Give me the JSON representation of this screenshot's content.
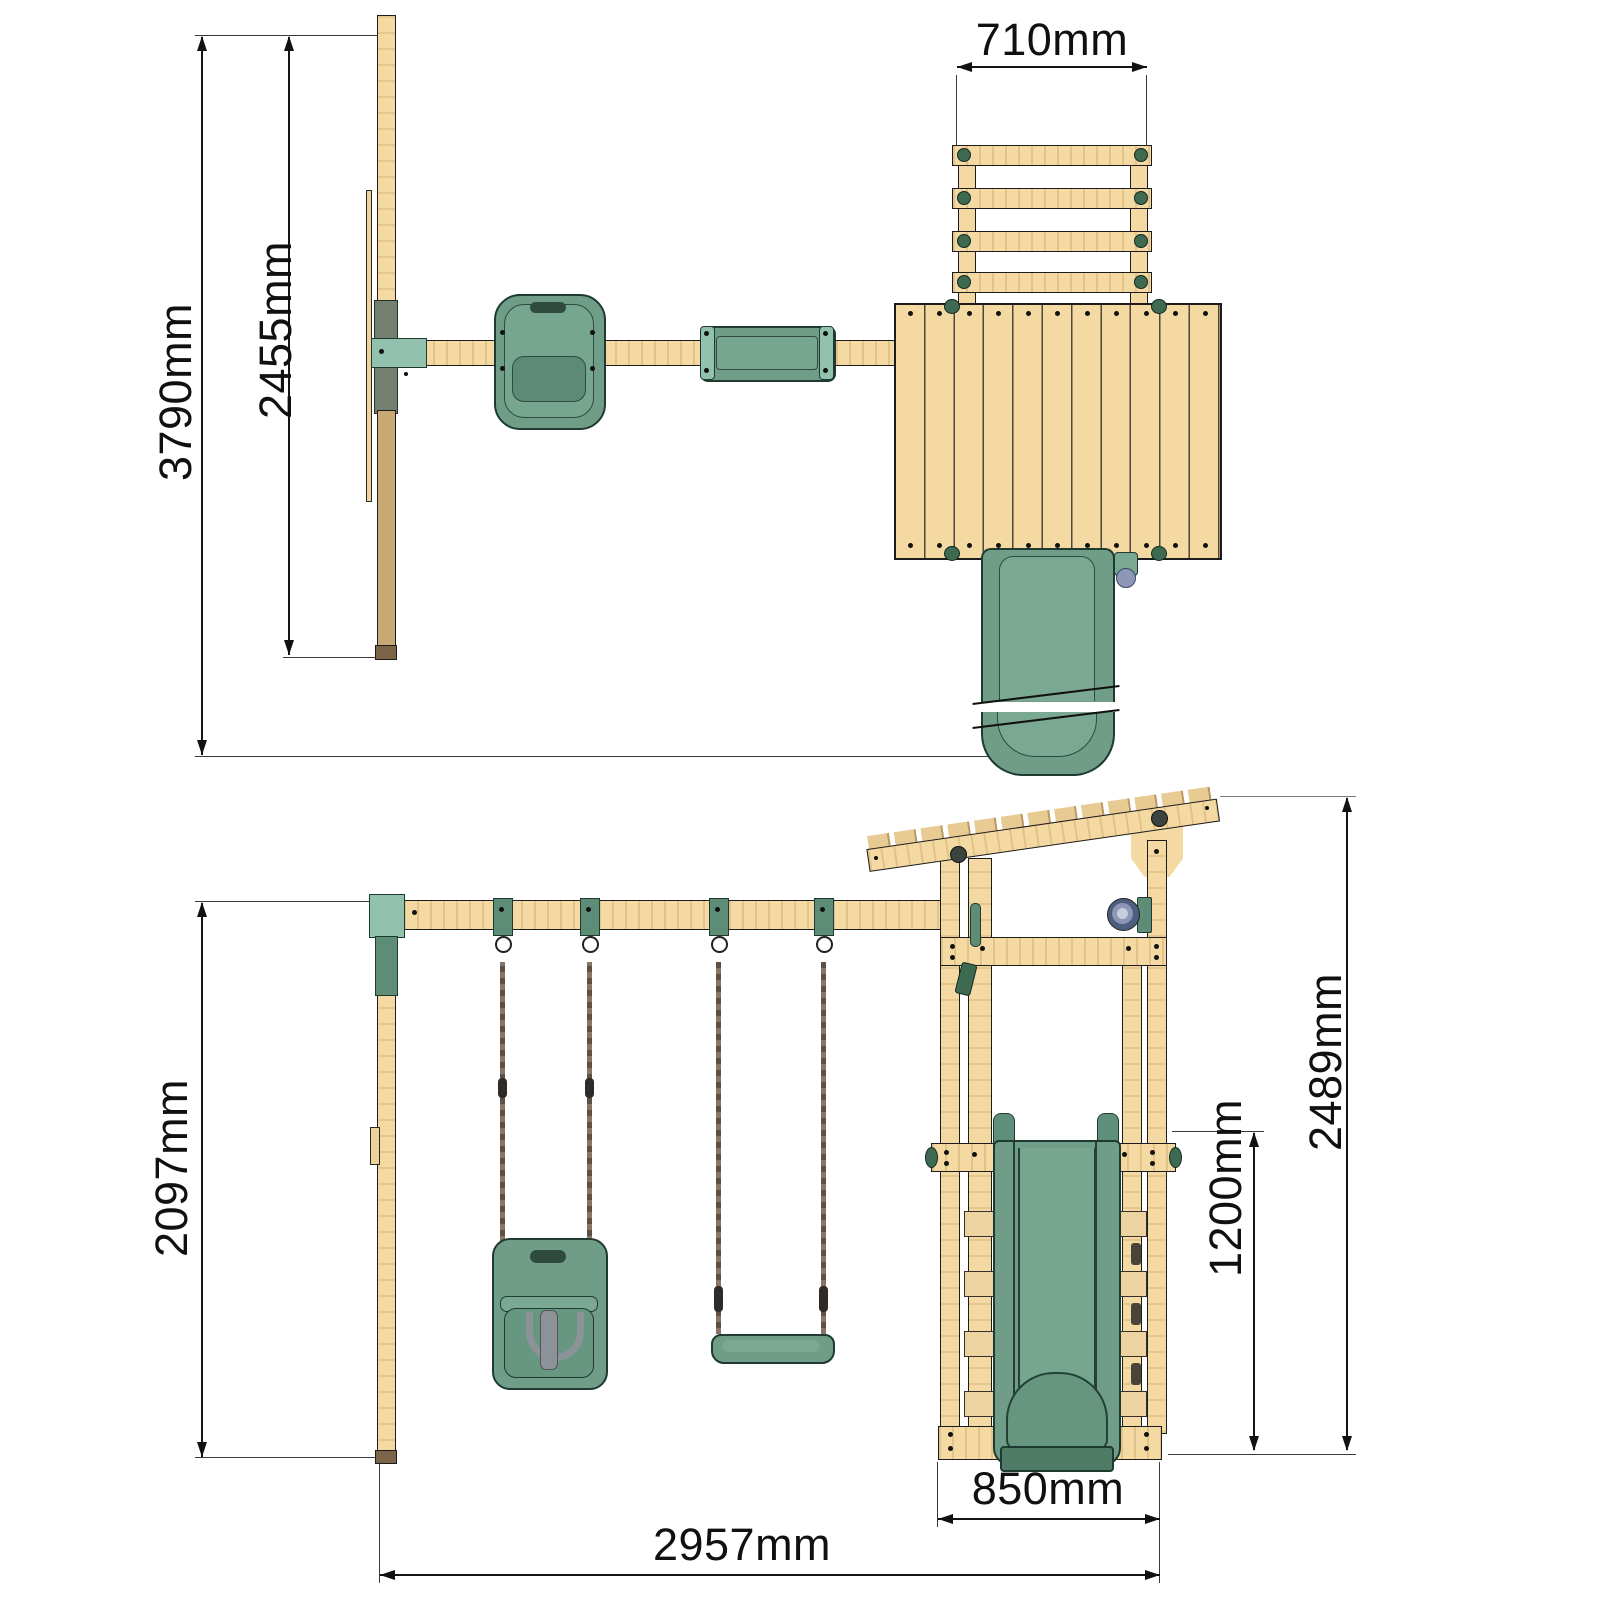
{
  "drawing": {
    "type": "playset dimension drawing",
    "units": "mm",
    "palette": {
      "wood_light": "#f4d9a3",
      "wood_dark": "#c8a873",
      "plastic_green": "#6f9d88",
      "bracket_mint": "#92c2ae",
      "line_black": "#141414"
    }
  },
  "top_view": {
    "dims": {
      "overall_depth": "3790mm",
      "swing_bay_depth": "2455mm",
      "ladder_width": "710mm"
    }
  },
  "front_view": {
    "dims": {
      "swing_frame_height": "2097mm",
      "overall_width": "2957mm",
      "tower_width": "850mm",
      "platform_height": "1200mm",
      "overall_height": "2489mm"
    }
  }
}
